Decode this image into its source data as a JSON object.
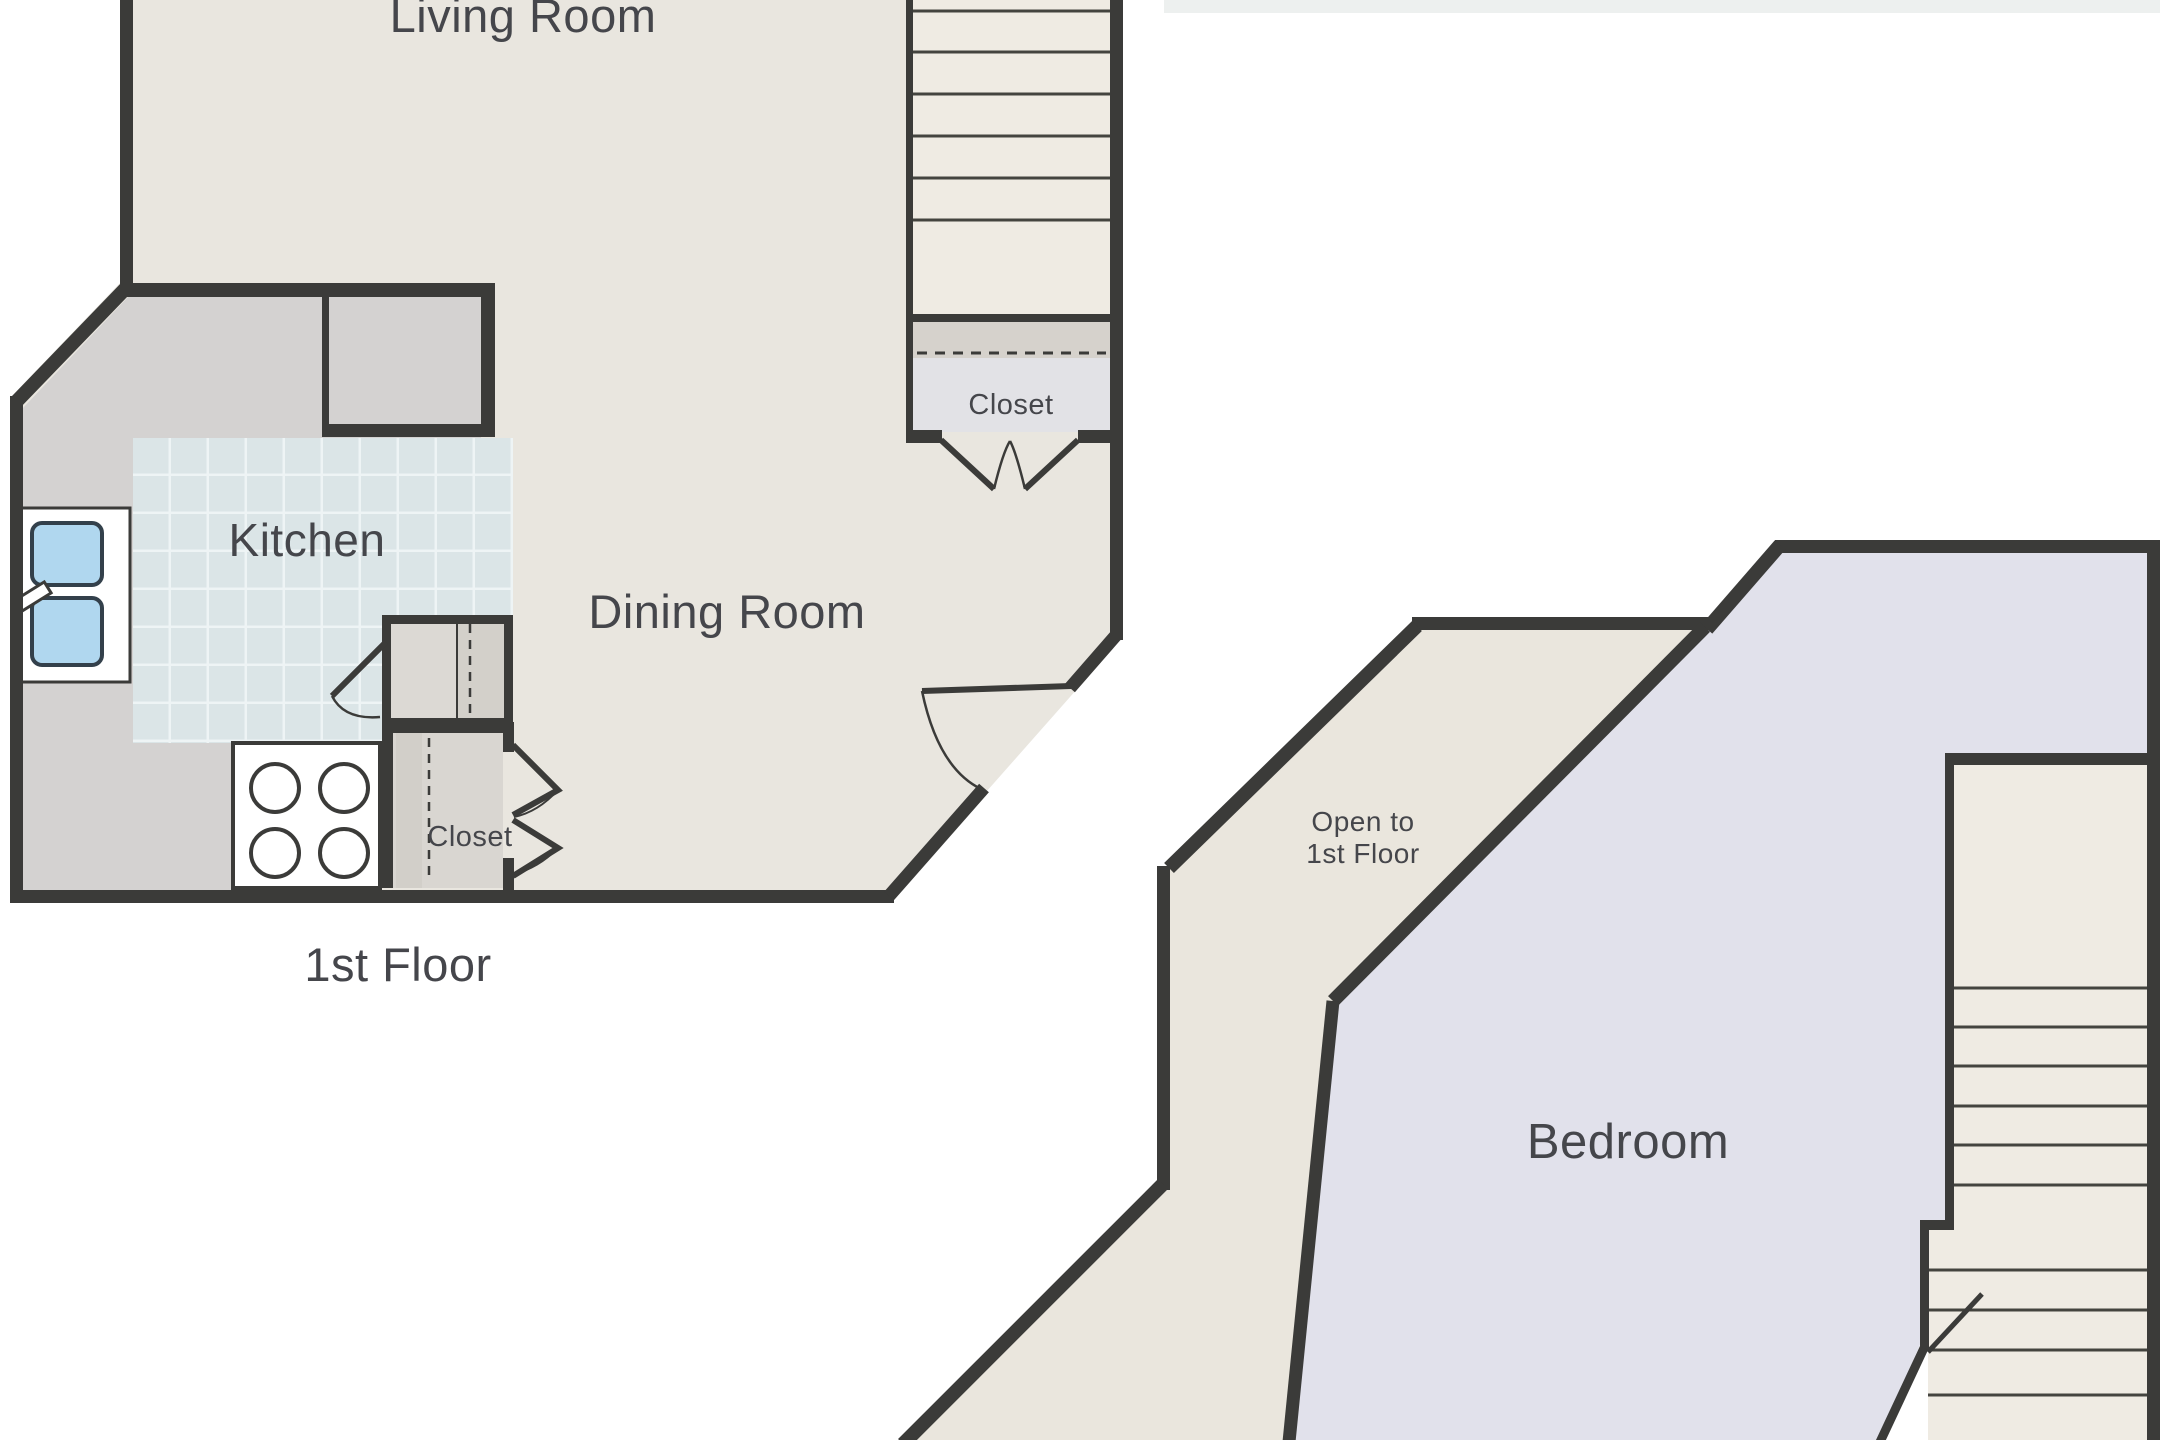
{
  "title": "Two-floor apartment floor plan",
  "labels": {
    "living_room": "Living Room",
    "kitchen": "Kitchen",
    "dining_room": "Dining Room",
    "stair_closet": "Closet",
    "kitchen_closet": "Closet",
    "first_floor_caption": "1st Floor",
    "open_line1": "Open to",
    "open_line2": "1st Floor",
    "bedroom": "Bedroom"
  },
  "colors": {
    "wall": "#3b3b39",
    "floor_beige": "#e9e6df",
    "open_band_beige": "#eae6dd",
    "stair_tread": "#efebe3",
    "counter_grey": "#d4d2d1",
    "pantry_grey": "#dcd9d4",
    "pantry_dark_grey": "#d3d0ca",
    "closet_grey": "#e2e2e6",
    "shelf_grey": "#d6d2cc",
    "tile_blue": "#dbe5e7",
    "tile_grid": "#eef4f5",
    "lavender": "#e1e1eb",
    "sink_blue": "#b0d7ef",
    "fixture_white": "#ffffff",
    "top_strip_artifact": "#edf0ef",
    "text": "#45464b"
  }
}
